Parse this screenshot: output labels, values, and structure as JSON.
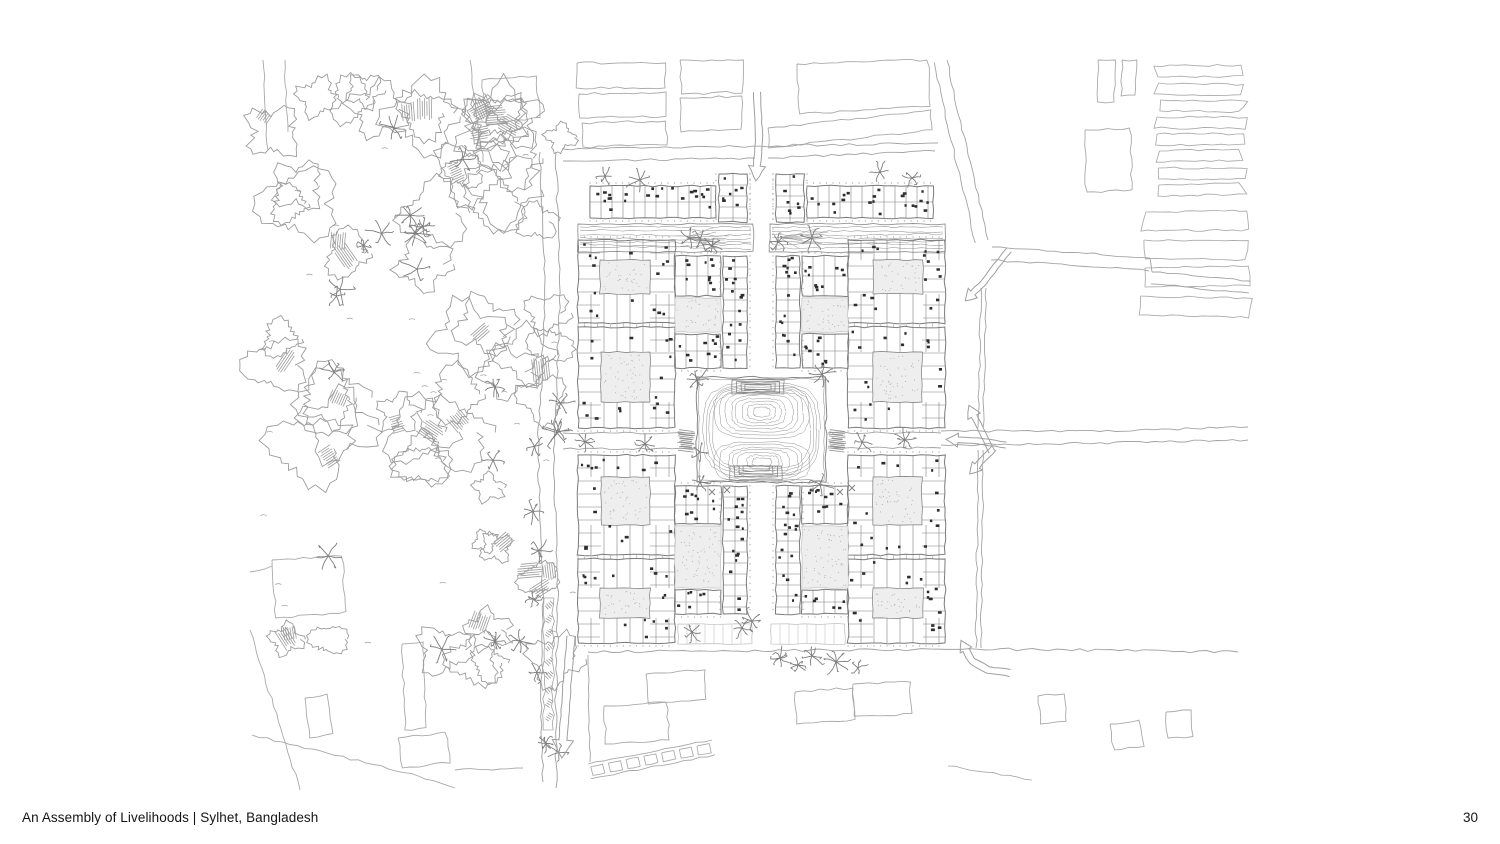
{
  "page": {
    "background": "#ffffff",
    "footer": {
      "title": "An Assembly of Livelihoods | Sylhet, Bangladesh",
      "page_number": "30"
    }
  },
  "plan": {
    "type": "architectural-site-plan",
    "seed": 7,
    "canvas": {
      "w": 1500,
      "h": 844
    },
    "colors": {
      "context": "#a9a9a9",
      "veg": "#9c9c9c",
      "veg2": "#b9b9b9",
      "wall": "#7a7a7a",
      "ink": "#2e2e2e",
      "dot": "#b3b3b3",
      "courtFill": "#eeeeee",
      "stall": "#c3c3c3",
      "water": "#949494",
      "arrow": "#9f9f9f",
      "road": "#a3a3a3",
      "text": "#141414"
    },
    "mirror_x": 1523,
    "forest": {
      "bounds": {
        "x": 258,
        "y": 66,
        "w": 316,
        "h": 600
      },
      "clearings": [
        [
          390,
          345,
          62
        ],
        [
          430,
          590,
          55
        ],
        [
          345,
          700,
          45
        ]
      ],
      "blob_count_upper": 50,
      "blob_count_lower": 16,
      "palm_count": 20,
      "hatch_count": 26
    },
    "west_road": {
      "left_line": [
        [
          540,
          152
        ],
        [
          545,
          300
        ],
        [
          538,
          450
        ],
        [
          543,
          600
        ],
        [
          541,
          700
        ],
        [
          543,
          782
        ]
      ],
      "right_line": [
        [
          556,
          152
        ],
        [
          560,
          300
        ],
        [
          554,
          450
        ],
        [
          558,
          600
        ],
        [
          556,
          700
        ],
        [
          556,
          788
        ]
      ],
      "median_island": {
        "x": 544,
        "y": 598,
        "w": 9,
        "h": 132
      }
    },
    "top_band_roads": [
      [
        [
          563,
          149
        ],
        [
          760,
          146
        ],
        [
          938,
          143
        ]
      ],
      [
        [
          563,
          161
        ],
        [
          755,
          158
        ]
      ],
      [
        [
          768,
          158
        ],
        [
          935,
          151
        ]
      ]
    ],
    "ne_roads": {
      "diag": {
        "a": [
          [
            947,
            60
          ],
          [
            962,
            130
          ],
          [
            978,
            195
          ],
          [
            988,
            240
          ]
        ],
        "gap": 13
      },
      "east1": {
        "a": [
          [
            992,
            247
          ],
          [
            1070,
            252
          ],
          [
            1150,
            258
          ]
        ],
        "gap": 13
      },
      "east2": {
        "a": [
          [
            1152,
            272
          ],
          [
            1250,
            281
          ]
        ],
        "gap": 12
      },
      "step": [
        [
          1150,
          258
        ],
        [
          1152,
          272
        ]
      ],
      "vert_upper": {
        "a": [
          [
            986,
            288
          ],
          [
            983,
            428
          ]
        ],
        "gap": 5
      },
      "vert_lower": {
        "a": [
          [
            983,
            450
          ],
          [
            981,
            648
          ]
        ],
        "gap": 5
      },
      "ew_outer_top": [
        [
          941,
          431
        ],
        [
          1100,
          431
        ],
        [
          1248,
          427
        ]
      ],
      "ew_outer_bot": [
        [
          941,
          445
        ],
        [
          1100,
          443
        ],
        [
          1248,
          440
        ]
      ]
    },
    "south_boundary": [
      [
        588,
        652
      ],
      [
        985,
        649
      ],
      [
        1238,
        652
      ]
    ],
    "west_site_edge": [
      [
        588,
        655
      ],
      [
        590,
        762
      ]
    ],
    "bottom_diag_line": [
      [
        948,
        766
      ],
      [
        1032,
        780
      ]
    ],
    "arrows": [
      {
        "name": "entry-arrow-north",
        "pts": [
          [
            757,
            92
          ],
          [
            759,
            135
          ],
          [
            757,
            166
          ]
        ],
        "w": 7,
        "hl": 15,
        "hw": 17
      },
      {
        "name": "west-road-arrow-south",
        "pts": [
          [
            571,
            636
          ],
          [
            566,
            698
          ],
          [
            563,
            740
          ]
        ],
        "w": 8,
        "hl": 18,
        "hw": 21
      },
      {
        "name": "east-junction-arrow-up",
        "pts": [
          [
            992,
            452
          ],
          [
            981,
            430
          ],
          [
            974,
            416
          ]
        ],
        "w": 6,
        "hl": 12,
        "hw": 14
      },
      {
        "name": "east-junction-arrow-left",
        "pts": [
          [
            1006,
            445
          ],
          [
            978,
            441
          ],
          [
            958,
            440
          ]
        ],
        "w": 6,
        "hl": 12,
        "hw": 14
      },
      {
        "name": "east-junction-arrow-down",
        "pts": [
          [
            994,
            448
          ],
          [
            983,
            459
          ],
          [
            977,
            466
          ]
        ],
        "w": 6,
        "hl": 11,
        "hw": 13
      },
      {
        "name": "ne-road-arrow-down",
        "pts": [
          [
            1009,
            250
          ],
          [
            996,
            266
          ],
          [
            984,
            282
          ],
          [
            973,
            293
          ]
        ],
        "w": 6,
        "hl": 11,
        "hw": 13
      },
      {
        "name": "se-road-arrow-up",
        "pts": [
          [
            1010,
            673
          ],
          [
            988,
            670
          ],
          [
            972,
            661
          ],
          [
            966,
            650
          ]
        ],
        "w": 7,
        "hl": 11,
        "hw": 13
      }
    ],
    "context_quads": [
      [
        [
          577,
          63
        ],
        [
          665,
          63
        ],
        [
          665,
          88
        ],
        [
          577,
          88
        ]
      ],
      [
        [
          579,
          94
        ],
        [
          665,
          92
        ],
        [
          666,
          116
        ],
        [
          580,
          118
        ]
      ],
      [
        [
          582,
          123
        ],
        [
          666,
          121
        ],
        [
          667,
          145
        ],
        [
          583,
          147
        ]
      ],
      [
        [
          680,
          60
        ],
        [
          744,
          60
        ],
        [
          742,
          92
        ],
        [
          681,
          94
        ]
      ],
      [
        [
          680,
          98
        ],
        [
          742,
          96
        ],
        [
          741,
          130
        ],
        [
          681,
          132
        ]
      ],
      [
        [
          797,
          64
        ],
        [
          928,
          60
        ],
        [
          930,
          106
        ],
        [
          799,
          114
        ]
      ],
      [
        [
          768,
          128
        ],
        [
          930,
          110
        ],
        [
          932,
          130
        ],
        [
          769,
          148
        ]
      ],
      [
        [
          1098,
          60
        ],
        [
          1116,
          60
        ],
        [
          1114,
          102
        ],
        [
          1097,
          102
        ]
      ],
      [
        [
          1122,
          60
        ],
        [
          1136,
          60
        ],
        [
          1135,
          96
        ],
        [
          1121,
          96
        ]
      ],
      [
        [
          1085,
          130
        ],
        [
          1130,
          128
        ],
        [
          1132,
          190
        ],
        [
          1086,
          192
        ]
      ],
      [
        [
          482,
          80
        ],
        [
          536,
          76
        ],
        [
          540,
          118
        ],
        [
          487,
          124
        ]
      ],
      [
        [
          272,
          560
        ],
        [
          342,
          556
        ],
        [
          346,
          612
        ],
        [
          276,
          618
        ]
      ],
      [
        [
          305,
          698
        ],
        [
          328,
          694
        ],
        [
          333,
          734
        ],
        [
          310,
          738
        ]
      ],
      [
        [
          402,
          644
        ],
        [
          423,
          642
        ],
        [
          426,
          728
        ],
        [
          405,
          730
        ]
      ],
      [
        [
          398,
          738
        ],
        [
          446,
          732
        ],
        [
          450,
          762
        ],
        [
          402,
          768
        ]
      ],
      [
        [
          646,
          674
        ],
        [
          704,
          670
        ],
        [
          706,
          700
        ],
        [
          648,
          704
        ]
      ],
      [
        [
          604,
          706
        ],
        [
          667,
          702
        ],
        [
          669,
          740
        ],
        [
          606,
          744
        ]
      ],
      [
        [
          795,
          692
        ],
        [
          853,
          688
        ],
        [
          855,
          720
        ],
        [
          797,
          724
        ]
      ],
      [
        [
          853,
          684
        ],
        [
          910,
          682
        ],
        [
          912,
          714
        ],
        [
          855,
          716
        ]
      ],
      [
        [
          1038,
          696
        ],
        [
          1064,
          694
        ],
        [
          1066,
          722
        ],
        [
          1040,
          724
        ]
      ],
      [
        [
          1110,
          724
        ],
        [
          1140,
          720
        ],
        [
          1144,
          746
        ],
        [
          1114,
          750
        ]
      ],
      [
        [
          1166,
          712
        ],
        [
          1191,
          710
        ],
        [
          1193,
          736
        ],
        [
          1168,
          738
        ]
      ]
    ],
    "context_lines": [
      [
        [
          263,
          60
        ],
        [
          268,
          150
        ]
      ],
      [
        [
          285,
          60
        ],
        [
          288,
          132
        ]
      ],
      [
        [
          470,
          60
        ],
        [
          483,
          162
        ]
      ],
      [
        [
          250,
          572
        ],
        [
          272,
          566
        ]
      ],
      [
        [
          250,
          630
        ],
        [
          300,
          790
        ]
      ],
      [
        [
          252,
          735
        ],
        [
          396,
          770
        ],
        [
          455,
          788
        ]
      ],
      [
        [
          455,
          770
        ],
        [
          523,
          768
        ]
      ]
    ],
    "ne_fields": {
      "thin": {
        "x": 1157,
        "w": 84,
        "y0": 66,
        "step": 17,
        "h": 11,
        "count": 8
      },
      "wide": {
        "x": 1142,
        "w": 104,
        "y0": 212,
        "step": 28,
        "h": 19,
        "count": 4
      }
    },
    "stripe_band": {
      "a": [
        588,
        764
      ],
      "b": [
        712,
        740
      ],
      "width": 15,
      "panels": 7
    },
    "site": {
      "top_strip": {
        "x": 590,
        "y": 186,
        "w": 126,
        "h": 32,
        "end_block": {
          "x": 719,
          "y": 174,
          "w": 28,
          "h": 48
        }
      },
      "veg_band": {
        "x": 585,
        "y": 164,
        "w": 163,
        "h": 22
      },
      "water_strip": {
        "x": 578,
        "y": 224,
        "w": 175,
        "h": 28
      },
      "stalls": {
        "x": 678,
        "y": 624,
        "w": 74,
        "h": 20
      },
      "lane_dots": [
        [
          750,
          174,
          750,
          238
        ],
        [
          773,
          174,
          773,
          238
        ]
      ],
      "outer_blocks": [
        {
          "x": 578,
          "y": 240,
          "w": 97,
          "h": 83,
          "court": [
            600,
            260,
            50,
            34
          ]
        },
        {
          "x": 578,
          "y": 327,
          "w": 97,
          "h": 101,
          "court": [
            601,
            352,
            49,
            50
          ]
        },
        {
          "x": 578,
          "y": 455,
          "w": 97,
          "h": 100,
          "court": [
            601,
            477,
            49,
            48
          ]
        },
        {
          "x": 578,
          "y": 559,
          "w": 97,
          "h": 84,
          "court": [
            600,
            588,
            50,
            30
          ]
        }
      ],
      "mini_bars_h": [
        {
          "x": 675,
          "y": 256,
          "w": 46,
          "h": 40
        },
        {
          "x": 675,
          "y": 334,
          "w": 46,
          "h": 34
        },
        {
          "x": 675,
          "y": 486,
          "w": 46,
          "h": 38
        },
        {
          "x": 675,
          "y": 590,
          "w": 46,
          "h": 24
        }
      ],
      "mini_bars_v": [
        {
          "x": 723,
          "y": 256,
          "w": 24,
          "h": 112
        },
        {
          "x": 723,
          "y": 486,
          "w": 24,
          "h": 128
        }
      ],
      "green_courts": [
        {
          "x": 675,
          "y": 298,
          "w": 46,
          "h": 34,
          "trees": 4
        },
        {
          "x": 675,
          "y": 526,
          "w": 46,
          "h": 62,
          "trees": 6
        }
      ],
      "ew_road": {
        "west": {
          "x1": 563,
          "x2": 695,
          "ytop": 433,
          "ybot": 449
        },
        "east": {
          "x1": 828,
          "x2": 941,
          "ytop": 433,
          "ybot": 448
        },
        "gate_hatch": [
          [
            676,
            431,
            20,
            21
          ],
          [
            827,
            431,
            20,
            21
          ]
        ]
      },
      "pond": {
        "x": 697,
        "y": 377,
        "w": 129,
        "h": 105,
        "upper_lobe": {
          "cy": 412,
          "ry": 26
        },
        "lower_lobe": {
          "cy": 462,
          "ry": 20
        },
        "ghat_top": {
          "cx": 758,
          "y": 380
        },
        "ghat_bottom": {
          "cx": 756,
          "y": 466
        },
        "xmarks": [
          [
            712,
            492
          ],
          [
            727,
            490
          ],
          [
            840,
            492
          ],
          [
            852,
            488
          ]
        ]
      }
    },
    "palms": [
      [
        585,
        442
      ],
      [
        645,
        444
      ],
      [
        700,
        452
      ],
      [
        862,
        442
      ],
      [
        905,
        440
      ],
      [
        700,
        240
      ],
      [
        712,
        246
      ],
      [
        778,
        242
      ],
      [
        812,
        238
      ],
      [
        697,
        380
      ],
      [
        700,
        482
      ],
      [
        822,
        374
      ],
      [
        820,
        484
      ],
      [
        780,
        658
      ],
      [
        798,
        665
      ],
      [
        812,
        656
      ],
      [
        836,
        662
      ],
      [
        858,
        668
      ],
      [
        742,
        628
      ],
      [
        752,
        621
      ],
      [
        692,
        632
      ],
      [
        880,
        172
      ],
      [
        912,
        178
      ],
      [
        640,
        180
      ],
      [
        605,
        176
      ],
      [
        690,
        238
      ]
    ]
  }
}
